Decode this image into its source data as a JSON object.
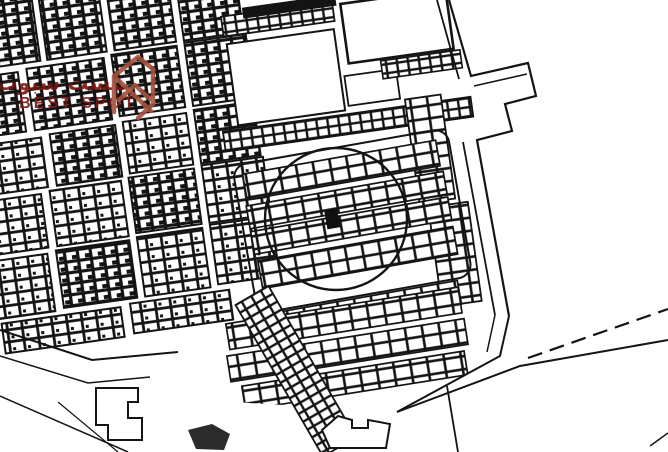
{
  "page": {
    "title": "Cadastral plot map with highlighted plot",
    "width": 668,
    "height": 452
  },
  "watermark": {
    "arabic": "بيست سبوت",
    "english": "BEST SPOT",
    "text_color": "#7b150e",
    "logo_color": "#a4513b"
  },
  "map": {
    "background_color": "#ffffff",
    "line_color": "#141414",
    "marker_color": "#111111",
    "marker": "filled-square-plot",
    "highlight": "circle-around-target-block"
  }
}
